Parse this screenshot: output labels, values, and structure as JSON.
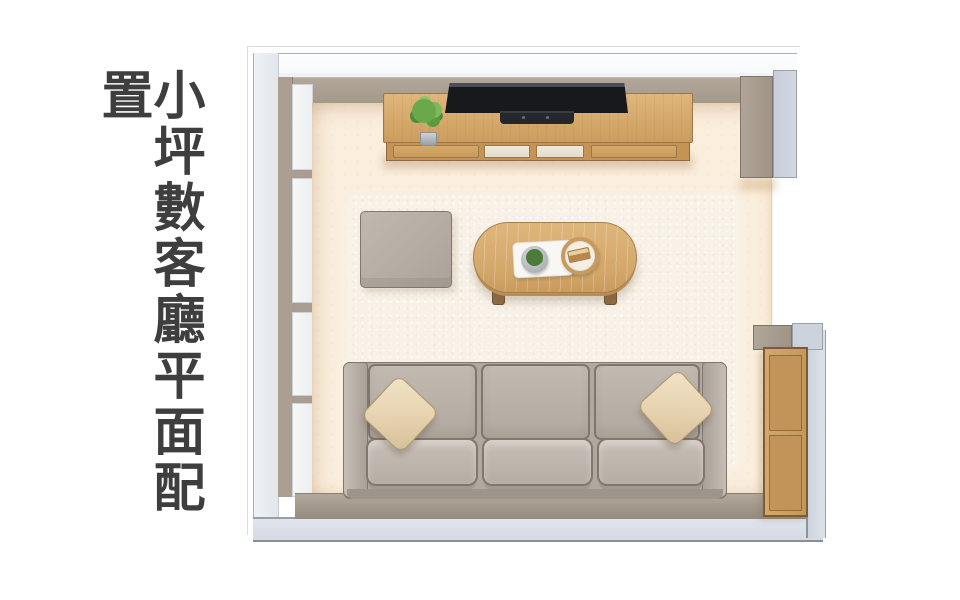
{
  "title": {
    "text": "小坪數客廳平面配置"
  },
  "palette": {
    "text": "#3e3e3e",
    "floor": "#fbeedd",
    "rug": "#f7f1e7",
    "wall_outer": "#e3e8ee",
    "wall_inner": "#a89d90",
    "wood": "#d5a96c",
    "wood_dark": "#c59356",
    "sofa": "#b5ada4",
    "pillow": "#ecdabd",
    "tv": "#17191d",
    "plant": "#5d9a3e"
  },
  "furniture": [
    {
      "name": "tv-console"
    },
    {
      "name": "tv"
    },
    {
      "name": "potted-plant"
    },
    {
      "name": "ottoman"
    },
    {
      "name": "coffee-table"
    },
    {
      "name": "serving-trays"
    },
    {
      "name": "three-seat-sofa"
    },
    {
      "name": "throw-pillows"
    },
    {
      "name": "side-cabinet"
    },
    {
      "name": "window-sliding-door"
    },
    {
      "name": "area-rug"
    }
  ]
}
